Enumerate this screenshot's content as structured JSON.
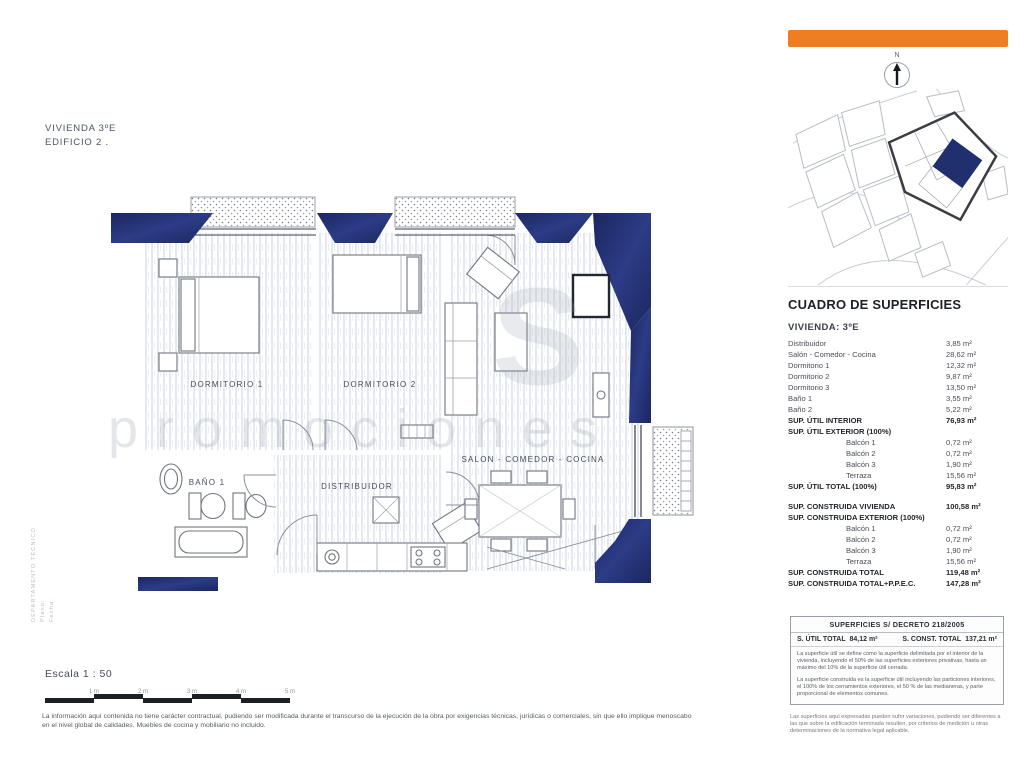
{
  "colors": {
    "accent": "#EF7D22",
    "wall": "#22306E",
    "hatch": "#C9D1E0"
  },
  "sheet": {
    "unit_title": "VIVIENDA 3ºE",
    "building": "EDIFICIO 2 .",
    "watermark_initial": "S",
    "watermark_word": "promociones",
    "side_text_1": "DEPARTAMENTO TÉCNICO",
    "side_text_2": "Plano:",
    "side_text_3": "Fecha:",
    "scale_label": "Escala 1 : 50",
    "scale_ticks": [
      "1 m",
      "2 m",
      "3 m",
      "4 m",
      "5 m"
    ],
    "disclaimer_line1": "La información aquí contenida no tiene carácter contractual, pudiendo ser modificada durante el transcurso de la ejecución de la obra por exigencias técnicas, jurídicas o comerciales, sin que ello implique menoscabo",
    "disclaimer_line2": "en el nivel global de calidades. Muebles de cocina y mobiliario no incluido."
  },
  "plan": {
    "rooms": {
      "dormitorio1": "DORMITORIO 1",
      "dormitorio2": "DORMITORIO 2",
      "salon": "SALON - COMEDOR - COCINA",
      "bano1": "BAÑO 1",
      "distribuidor": "DISTRIBUIDOR"
    }
  },
  "panel": {
    "compass_label": "N",
    "heading": "CUADRO DE SUPERFICIES",
    "vivienda_label": "VIVIENDA:  3ºE",
    "rows": [
      {
        "label": "Distribuidor",
        "value": "3,85 m²"
      },
      {
        "label": "Salón - Comedor - Cocina",
        "value": "28,62 m²"
      },
      {
        "label": "Dormitorio 1",
        "value": "12,32 m²"
      },
      {
        "label": "Dormitorio 2",
        "value": "9,87 m²"
      },
      {
        "label": "Dormitorio 3",
        "value": "13,50 m²"
      },
      {
        "label": "Baño 1",
        "value": "3,55 m²"
      },
      {
        "label": "Baño 2",
        "value": "5,22 m²"
      },
      {
        "label": "SUP. ÚTIL INTERIOR",
        "value": "76,93 m²",
        "bold": true
      },
      {
        "label": "SUP. ÚTIL EXTERIOR (100%)",
        "value": "",
        "bold": true
      },
      {
        "label": "Balcón 1",
        "value": "0,72 m²",
        "indent": true
      },
      {
        "label": "Balcón 2",
        "value": "0,72 m²",
        "indent": true
      },
      {
        "label": "Balcón 3",
        "value": "1,90 m²",
        "indent": true
      },
      {
        "label": "Terraza",
        "value": "15,56 m²",
        "indent": true
      },
      {
        "label": "SUP. ÚTIL TOTAL  (100%)",
        "value": "95,83 m²",
        "bold": true
      },
      {
        "label": "SUP. CONSTRUIDA VIVIENDA",
        "value": "100,58 m²",
        "bold": true,
        "gap": true
      },
      {
        "label": "SUP. CONSTRUIDA EXTERIOR (100%)",
        "value": "",
        "bold": true
      },
      {
        "label": "Balcón 1",
        "value": "0,72 m²",
        "indent": true
      },
      {
        "label": "Balcón 2",
        "value": "0,72 m²",
        "indent": true
      },
      {
        "label": "Balcón 3",
        "value": "1,90 m²",
        "indent": true
      },
      {
        "label": "Terraza",
        "value": "15,56 m²",
        "indent": true
      },
      {
        "label": "SUP. CONSTRUIDA TOTAL",
        "value": "119,48 m²",
        "bold": true
      },
      {
        "label": "SUP. CONSTRUIDA TOTAL+P.P.E.C.",
        "value": "147,28 m²",
        "bold": true
      }
    ],
    "decree": {
      "title": "SUPERFICIES S/ DECRETO 218/2005",
      "util_label": "S. ÚTIL TOTAL",
      "util_value": "84,12 m²",
      "const_label": "S. CONST. TOTAL",
      "const_value": "137,21 m²",
      "note1": "La superficie útil se define como la superficie delimitada por el interior de la vivienda, incluyendo el 50% de las superficies exteriores privativas, hasta un máximo del 10% de la superficie útil cerrada.",
      "note2": "La superficie construida es la superficie útil incluyendo las particiones interiores, el 100% de los cerramientos exteriores, el 50 % de las medianeras, y parte proporcional de elementos comunes."
    },
    "footnote": "Las superficies aquí expresadas pueden sufrir variaciones, pudiendo ser diferentes a las que sobre la edificación terminada resulten, por criterios de medición u otras determinaciones de la normativa legal aplicable."
  }
}
